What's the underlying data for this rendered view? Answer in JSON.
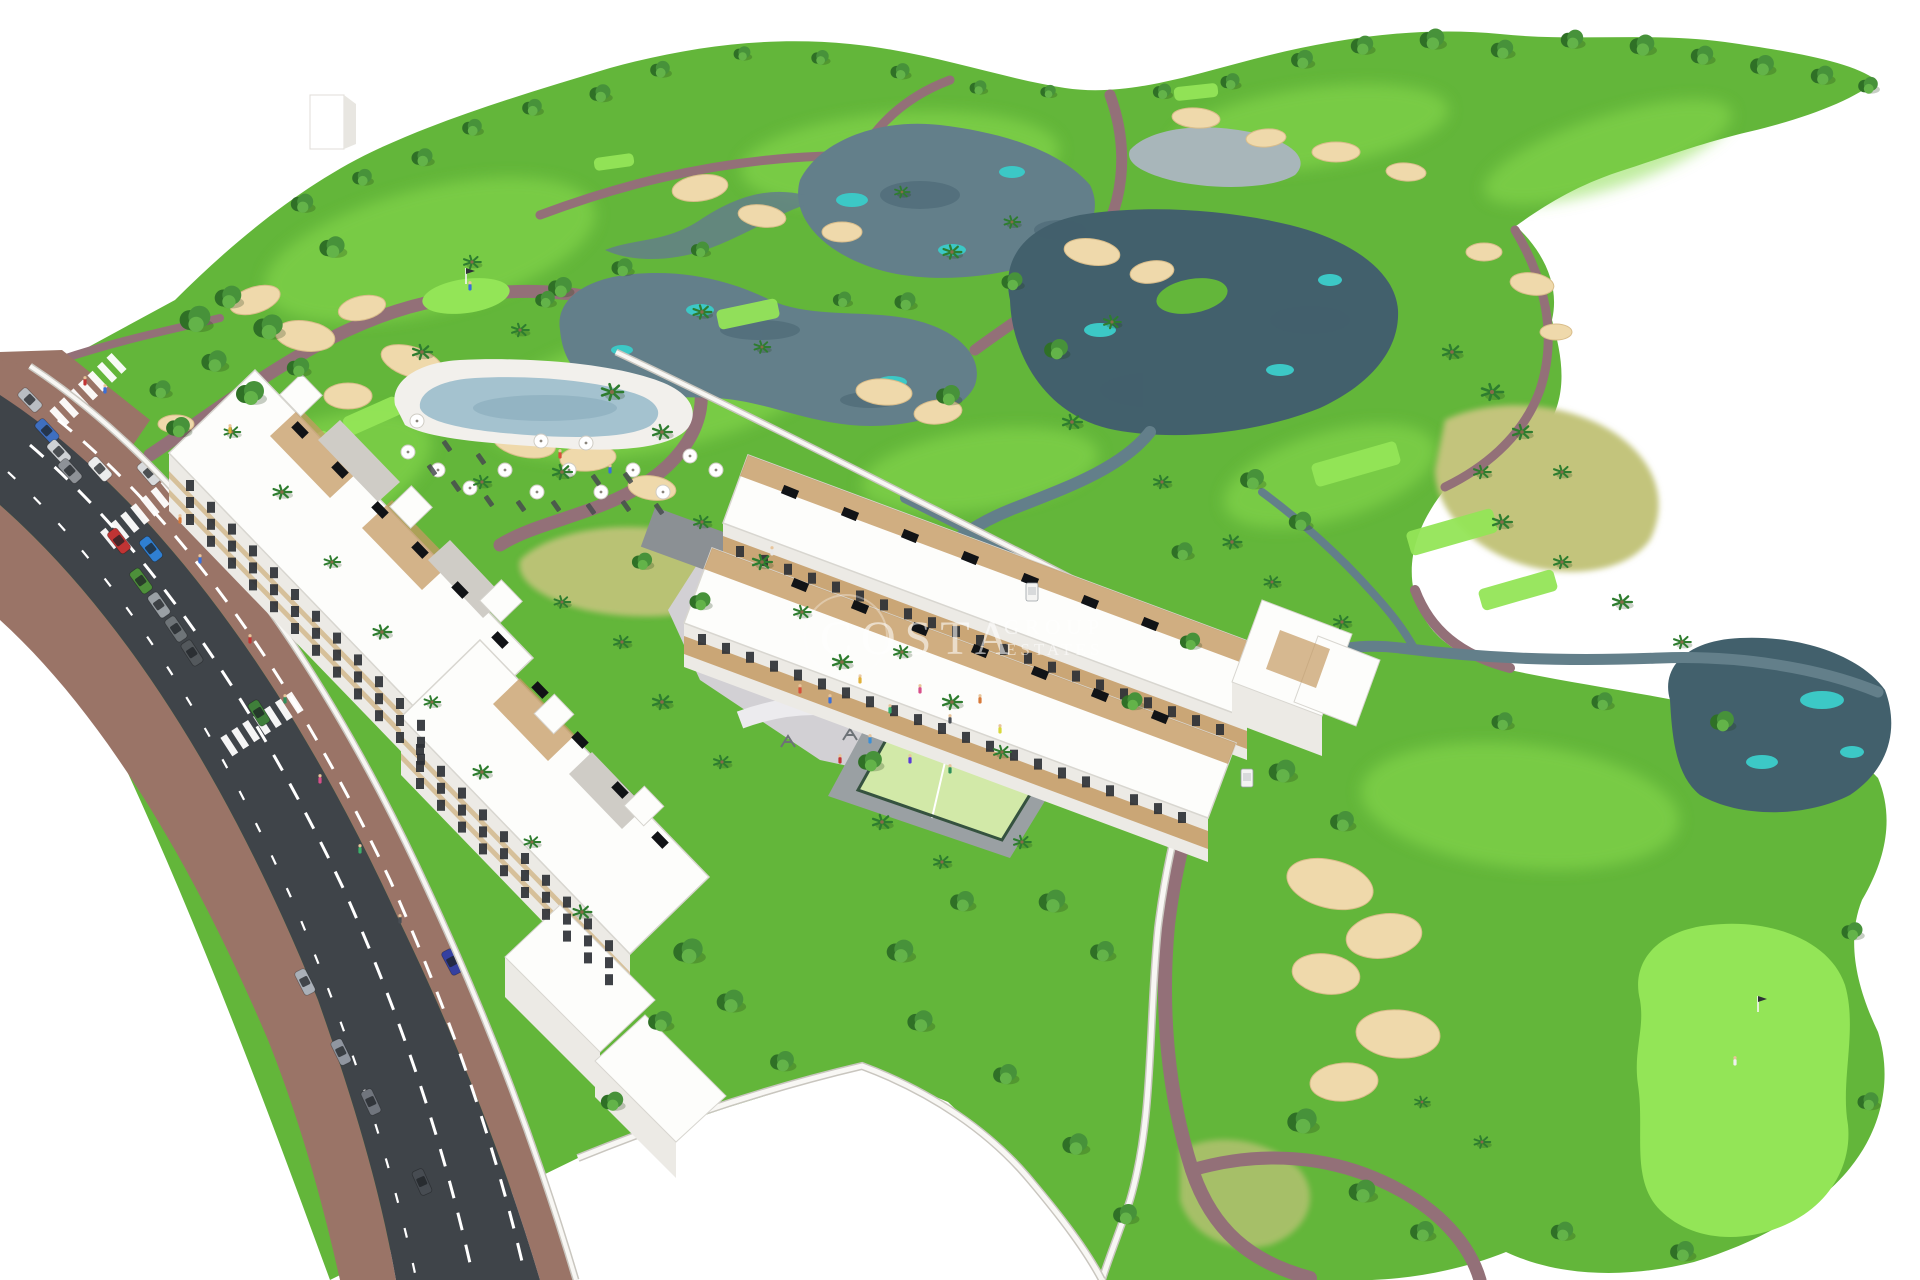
{
  "watermark": {
    "line1": "COSTA",
    "line2": "GROUP",
    "line3": "ESTATES"
  },
  "palette": {
    "bg": "#ffffff",
    "grass": "#63b63a",
    "grassDark": "#4f9e2f",
    "fairwayLight": "#8bdc4f",
    "teeGreen": "#93e557",
    "dryGrass": "#c3c47c",
    "drySpeck": "#b39a58",
    "pond": "#637f8a",
    "pondDark": "#42606c",
    "pondTeal": "#3cc8c6",
    "pondGray": "#a8b6ba",
    "sand": "#efd9ab",
    "sandDark": "#d9bd8a",
    "path": "#937078",
    "roadAsphalt": "#3f4449",
    "roadLine": "#ffffff",
    "sidewalk": "#9a7467",
    "building": "#fdfdfb",
    "buildingShade": "#eceae5",
    "beige": "#d6c09a",
    "window": "#2e3136",
    "wood": "#c49a63",
    "solar": "#111316",
    "plaza": "#d2d0d4",
    "plazaPath": "#ecebee",
    "pool": "#a4c2cf",
    "poolDeck": "#f2f0ec",
    "court": "#d2e9a8",
    "courtFence": "#35523f",
    "treeDark": "#2f7026",
    "tree": "#47923a",
    "treeLight": "#63b349",
    "palm": "#2e7d2f",
    "trunk": "#8a6a4a",
    "wall": "#f8f7f4",
    "wallShade": "#c9c6bf",
    "watermark": "rgba(255,255,255,0.58)"
  },
  "scene": {
    "fairways": [
      [
        430,
        250,
        170,
        62,
        -14
      ],
      [
        900,
        160,
        160,
        48,
        -4
      ],
      [
        1310,
        128,
        140,
        40,
        -8
      ],
      [
        300,
        486,
        140,
        58,
        -22
      ],
      [
        660,
        388,
        180,
        62,
        -12
      ],
      [
        1330,
        476,
        110,
        44,
        -16
      ],
      [
        1520,
        806,
        160,
        62,
        6
      ],
      [
        1608,
        152,
        130,
        36,
        -18
      ],
      [
        980,
        470,
        120,
        40,
        -8
      ]
    ],
    "bunkers": [
      [
        255,
        300,
        26,
        13,
        -18
      ],
      [
        305,
        336,
        30,
        15,
        8
      ],
      [
        362,
        308,
        24,
        12,
        -12
      ],
      [
        412,
        362,
        32,
        15,
        18
      ],
      [
        348,
        396,
        24,
        13,
        0
      ],
      [
        462,
        402,
        28,
        14,
        -8
      ],
      [
        524,
        442,
        32,
        15,
        12
      ],
      [
        588,
        458,
        28,
        13,
        -4
      ],
      [
        652,
        488,
        24,
        12,
        8
      ],
      [
        700,
        188,
        28,
        13,
        -8
      ],
      [
        762,
        216,
        24,
        11,
        8
      ],
      [
        842,
        232,
        20,
        10,
        0
      ],
      [
        1092,
        252,
        28,
        13,
        8
      ],
      [
        1152,
        272,
        22,
        11,
        -8
      ],
      [
        1196,
        118,
        24,
        10,
        4
      ],
      [
        1266,
        138,
        20,
        9,
        -4
      ],
      [
        1336,
        152,
        24,
        10,
        0
      ],
      [
        1406,
        172,
        20,
        9,
        4
      ],
      [
        1484,
        252,
        18,
        9,
        0
      ],
      [
        1532,
        284,
        22,
        11,
        8
      ],
      [
        1556,
        332,
        16,
        8,
        0
      ],
      [
        884,
        392,
        28,
        13,
        4
      ],
      [
        938,
        412,
        24,
        12,
        -6
      ],
      [
        1330,
        884,
        44,
        24,
        14
      ],
      [
        1384,
        936,
        38,
        22,
        -8
      ],
      [
        1326,
        974,
        34,
        20,
        8
      ],
      [
        1398,
        1034,
        42,
        24,
        4
      ],
      [
        1344,
        1082,
        34,
        19,
        -4
      ],
      [
        176,
        424,
        18,
        9,
        0
      ]
    ],
    "tees": [
      [
        232,
        492,
        58,
        20,
        -24
      ],
      [
        302,
        452,
        62,
        22,
        -24
      ],
      [
        372,
        416,
        58,
        20,
        -24
      ],
      [
        748,
        314,
        62,
        20,
        -12
      ],
      [
        614,
        162,
        40,
        13,
        -8
      ],
      [
        1356,
        464,
        88,
        24,
        -16
      ],
      [
        1452,
        532,
        90,
        25,
        -16
      ],
      [
        1518,
        590,
        78,
        22,
        -16
      ],
      [
        770,
        556,
        40,
        15,
        -10
      ],
      [
        1196,
        92,
        44,
        14,
        -6
      ]
    ],
    "trees": [
      [
        195,
        320,
        1.1
      ],
      [
        228,
        298,
        0.95
      ],
      [
        268,
        328,
        1.05
      ],
      [
        214,
        362,
        0.9
      ],
      [
        250,
        394,
        1.0
      ],
      [
        298,
        368,
        0.8
      ],
      [
        178,
        428,
        0.85
      ],
      [
        160,
        390,
        0.75
      ],
      [
        332,
        248,
        0.9
      ],
      [
        302,
        204,
        0.8
      ],
      [
        362,
        178,
        0.7
      ],
      [
        422,
        158,
        0.75
      ],
      [
        472,
        128,
        0.7
      ],
      [
        532,
        108,
        0.7
      ],
      [
        600,
        94,
        0.75
      ],
      [
        660,
        70,
        0.7
      ],
      [
        742,
        54,
        0.6
      ],
      [
        820,
        58,
        0.62
      ],
      [
        900,
        72,
        0.68
      ],
      [
        978,
        88,
        0.6
      ],
      [
        1048,
        92,
        0.55
      ],
      [
        560,
        288,
        0.85
      ],
      [
        622,
        268,
        0.75
      ],
      [
        700,
        250,
        0.65
      ],
      [
        545,
        300,
        0.7
      ],
      [
        905,
        302,
        0.75
      ],
      [
        948,
        396,
        0.85
      ],
      [
        842,
        300,
        0.65
      ],
      [
        1056,
        350,
        0.85
      ],
      [
        1012,
        282,
        0.75
      ],
      [
        1162,
        92,
        0.65
      ],
      [
        1230,
        82,
        0.68
      ],
      [
        1302,
        60,
        0.78
      ],
      [
        1362,
        46,
        0.8
      ],
      [
        1432,
        40,
        0.88
      ],
      [
        1502,
        50,
        0.8
      ],
      [
        1572,
        40,
        0.8
      ],
      [
        1642,
        46,
        0.88
      ],
      [
        1702,
        56,
        0.8
      ],
      [
        1762,
        66,
        0.85
      ],
      [
        1822,
        76,
        0.8
      ],
      [
        1868,
        86,
        0.7
      ],
      [
        1252,
        480,
        0.85
      ],
      [
        1300,
        522,
        0.8
      ],
      [
        1182,
        552,
        0.75
      ],
      [
        1282,
        772,
        0.95
      ],
      [
        1342,
        822,
        0.85
      ],
      [
        1302,
        1122,
        1.05
      ],
      [
        1362,
        1192,
        0.95
      ],
      [
        1422,
        1232,
        0.85
      ],
      [
        1562,
        1232,
        0.8
      ],
      [
        1682,
        1252,
        0.85
      ],
      [
        1852,
        932,
        0.75
      ],
      [
        1868,
        1102,
        0.75
      ],
      [
        1502,
        722,
        0.75
      ],
      [
        1602,
        702,
        0.75
      ],
      [
        1722,
        722,
        0.85
      ],
      [
        688,
        952,
        1.05
      ],
      [
        730,
        1002,
        0.95
      ],
      [
        660,
        1022,
        0.85
      ],
      [
        782,
        1062,
        0.85
      ],
      [
        900,
        952,
        0.95
      ],
      [
        962,
        902,
        0.85
      ],
      [
        1052,
        902,
        0.95
      ],
      [
        1102,
        952,
        0.85
      ],
      [
        870,
        762,
        0.85
      ],
      [
        700,
        602,
        0.75
      ],
      [
        642,
        562,
        0.72
      ],
      [
        1132,
        702,
        0.75
      ],
      [
        1190,
        642,
        0.72
      ],
      [
        612,
        1102,
        0.8
      ],
      [
        920,
        1022,
        0.9
      ],
      [
        1005,
        1075,
        0.85
      ],
      [
        1075,
        1145,
        0.9
      ],
      [
        1125,
        1215,
        0.85
      ]
    ],
    "palms": [
      [
        422,
        352,
        0.9
      ],
      [
        520,
        330,
        0.8
      ],
      [
        612,
        392,
        1.0
      ],
      [
        662,
        432,
        0.9
      ],
      [
        482,
        482,
        0.8
      ],
      [
        562,
        472,
        0.9
      ],
      [
        702,
        522,
        0.8
      ],
      [
        762,
        562,
        0.9
      ],
      [
        802,
        612,
        0.8
      ],
      [
        842,
        662,
        0.9
      ],
      [
        622,
        642,
        0.8
      ],
      [
        562,
        602,
        0.75
      ],
      [
        662,
        702,
        0.9
      ],
      [
        722,
        762,
        0.8
      ],
      [
        902,
        652,
        0.8
      ],
      [
        952,
        702,
        0.9
      ],
      [
        1002,
        752,
        0.8
      ],
      [
        882,
        822,
        0.9
      ],
      [
        942,
        862,
        0.8
      ],
      [
        1022,
        842,
        0.8
      ],
      [
        472,
        262,
        0.8
      ],
      [
        702,
        312,
        0.85
      ],
      [
        762,
        347,
        0.75
      ],
      [
        952,
        252,
        0.85
      ],
      [
        1012,
        222,
        0.75
      ],
      [
        902,
        192,
        0.7
      ],
      [
        1112,
        322,
        0.8
      ],
      [
        1072,
        422,
        0.9
      ],
      [
        1162,
        482,
        0.8
      ],
      [
        1232,
        542,
        0.85
      ],
      [
        1272,
        582,
        0.75
      ],
      [
        1342,
        622,
        0.8
      ],
      [
        1452,
        352,
        0.9
      ],
      [
        1492,
        392,
        1.0
      ],
      [
        1522,
        432,
        0.9
      ],
      [
        1482,
        472,
        0.8
      ],
      [
        1562,
        472,
        0.8
      ],
      [
        1502,
        522,
        0.9
      ],
      [
        1562,
        562,
        0.8
      ],
      [
        1622,
        602,
        0.9
      ],
      [
        1682,
        642,
        0.8
      ],
      [
        232,
        432,
        0.75
      ],
      [
        282,
        492,
        0.85
      ],
      [
        332,
        562,
        0.75
      ],
      [
        382,
        632,
        0.85
      ],
      [
        432,
        702,
        0.75
      ],
      [
        482,
        772,
        0.85
      ],
      [
        532,
        842,
        0.75
      ],
      [
        582,
        912,
        0.85
      ],
      [
        1482,
        1142,
        0.75
      ],
      [
        1422,
        1102,
        0.7
      ]
    ],
    "cars": [
      [
        30,
        400,
        46,
        "#b9bdc2"
      ],
      [
        47,
        431,
        47,
        "#3f6fc0"
      ],
      [
        59,
        452,
        47,
        "#cfd2d5"
      ],
      [
        70,
        471,
        48,
        "#8e9297"
      ],
      [
        100,
        469,
        48,
        "#eceded"
      ],
      [
        149,
        473,
        49,
        "#d8dadc"
      ],
      [
        119,
        541,
        52,
        "#c03434"
      ],
      [
        151,
        549,
        52,
        "#2f7fd2"
      ],
      [
        141,
        581,
        54,
        "#4d8f3a"
      ],
      [
        159,
        605,
        55,
        "#9aa0a5"
      ],
      [
        176,
        629,
        56,
        "#6e7478"
      ],
      [
        192,
        653,
        57,
        "#53585c"
      ],
      [
        259,
        713,
        58,
        "#3f7f3a"
      ],
      [
        452,
        962,
        62,
        "#3540a0"
      ],
      [
        341,
        1052,
        64,
        "#9096a0"
      ],
      [
        371,
        1102,
        65,
        "#70757d"
      ],
      [
        305,
        982,
        63,
        "#aab0b8"
      ],
      [
        422,
        1182,
        66,
        "#474c52"
      ],
      [
        622,
        792,
        46,
        "#2c3036"
      ],
      [
        982,
        586,
        21,
        "#2e323a"
      ],
      [
        1013,
        601,
        21,
        "#3a4150"
      ]
    ],
    "carts": [
      [
        1247,
        778
      ],
      [
        1032,
        592
      ]
    ],
    "umbrellas": [
      [
        408,
        452
      ],
      [
        438,
        470
      ],
      [
        470,
        488
      ],
      [
        505,
        470
      ],
      [
        537,
        492
      ],
      [
        569,
        470
      ],
      [
        601,
        492
      ],
      [
        633,
        470
      ],
      [
        663,
        492
      ],
      [
        541,
        441
      ],
      [
        586,
        443
      ],
      [
        417,
        421
      ],
      [
        690,
        456
      ],
      [
        716,
        470
      ],
      [
        748,
        486
      ]
    ],
    "loungers": [
      [
        432,
        470
      ],
      [
        456,
        486
      ],
      [
        489,
        501
      ],
      [
        521,
        506
      ],
      [
        556,
        506
      ],
      [
        591,
        509
      ],
      [
        626,
        506
      ],
      [
        659,
        509
      ],
      [
        447,
        446
      ],
      [
        481,
        459
      ],
      [
        628,
        478
      ],
      [
        596,
        480
      ]
    ],
    "people": [
      [
        800,
        690,
        "#d84f3a"
      ],
      [
        830,
        700,
        "#3a6fd8"
      ],
      [
        860,
        680,
        "#e0b13a"
      ],
      [
        890,
        710,
        "#3ab06a"
      ],
      [
        920,
        690,
        "#d84f8a"
      ],
      [
        950,
        720,
        "#4a4f55"
      ],
      [
        980,
        700,
        "#d87a3a"
      ],
      [
        870,
        740,
        "#3a8fd8"
      ],
      [
        840,
        760,
        "#c23434"
      ],
      [
        910,
        760,
        "#5a3ad8"
      ],
      [
        950,
        770,
        "#2e8f5a"
      ],
      [
        1000,
        730,
        "#d8d83a"
      ],
      [
        180,
        520,
        "#d87a3a"
      ],
      [
        200,
        560,
        "#3a6fd8"
      ],
      [
        250,
        640,
        "#c23434"
      ],
      [
        285,
        700,
        "#2e8f5a"
      ],
      [
        230,
        430,
        "#e0b13a"
      ],
      [
        320,
        780,
        "#d84f8a"
      ],
      [
        360,
        850,
        "#3ab06a"
      ],
      [
        400,
        920,
        "#4a4f55"
      ],
      [
        85,
        382,
        "#c23434"
      ],
      [
        105,
        390,
        "#3a6fd8"
      ],
      [
        560,
        455,
        "#d84f3a"
      ],
      [
        610,
        470,
        "#3a6fd8"
      ],
      [
        1735,
        1062,
        "#f0f0f0"
      ],
      [
        470,
        287,
        "#3a6fd8"
      ],
      [
        772,
        552,
        "#e8e8e8"
      ]
    ],
    "playground": [
      [
        812,
        700
      ],
      [
        850,
        735
      ],
      [
        892,
        712
      ],
      [
        930,
        742
      ],
      [
        968,
        700
      ],
      [
        755,
        668
      ],
      [
        788,
        742
      ],
      [
        860,
        772
      ],
      [
        912,
        780
      ]
    ],
    "solarPanels": [
      [
        300,
        430,
        46
      ],
      [
        340,
        470,
        46
      ],
      [
        380,
        510,
        46
      ],
      [
        420,
        550,
        46
      ],
      [
        460,
        590,
        46
      ],
      [
        500,
        640,
        46
      ],
      [
        540,
        690,
        46
      ],
      [
        580,
        740,
        46
      ],
      [
        620,
        790,
        46
      ],
      [
        660,
        840,
        46
      ],
      [
        790,
        492,
        22
      ],
      [
        850,
        514,
        22
      ],
      [
        910,
        536,
        22
      ],
      [
        970,
        558,
        22
      ],
      [
        1030,
        580,
        22
      ],
      [
        1090,
        602,
        22
      ],
      [
        1150,
        624,
        22
      ],
      [
        800,
        585,
        22
      ],
      [
        860,
        607,
        22
      ],
      [
        920,
        629,
        22
      ],
      [
        980,
        651,
        22
      ],
      [
        1040,
        673,
        22
      ],
      [
        1100,
        695,
        22
      ],
      [
        1160,
        717,
        22
      ]
    ],
    "windowRuns": [
      {
        "start": [
          186,
          480
        ],
        "step": [
          21,
          21.8
        ],
        "n": 12,
        "rows": 3,
        "rowGap": 17
      },
      {
        "start": [
          416,
          744
        ],
        "step": [
          21,
          21.8
        ],
        "n": 10,
        "rows": 3,
        "rowGap": 17
      },
      {
        "start": [
          736,
          546
        ],
        "step": [
          24,
          8.9
        ],
        "n": 21,
        "rows": 1,
        "rowGap": 0
      },
      {
        "start": [
          698,
          634
        ],
        "step": [
          24,
          8.9
        ],
        "n": 21,
        "rows": 1,
        "rowGap": 0
      }
    ],
    "crosswalks": [
      [
        88,
        390,
        47
      ],
      [
        140,
        514,
        51
      ],
      [
        262,
        724,
        57
      ]
    ],
    "flags": [
      [
        466,
        284
      ],
      [
        1758,
        1012
      ]
    ]
  }
}
